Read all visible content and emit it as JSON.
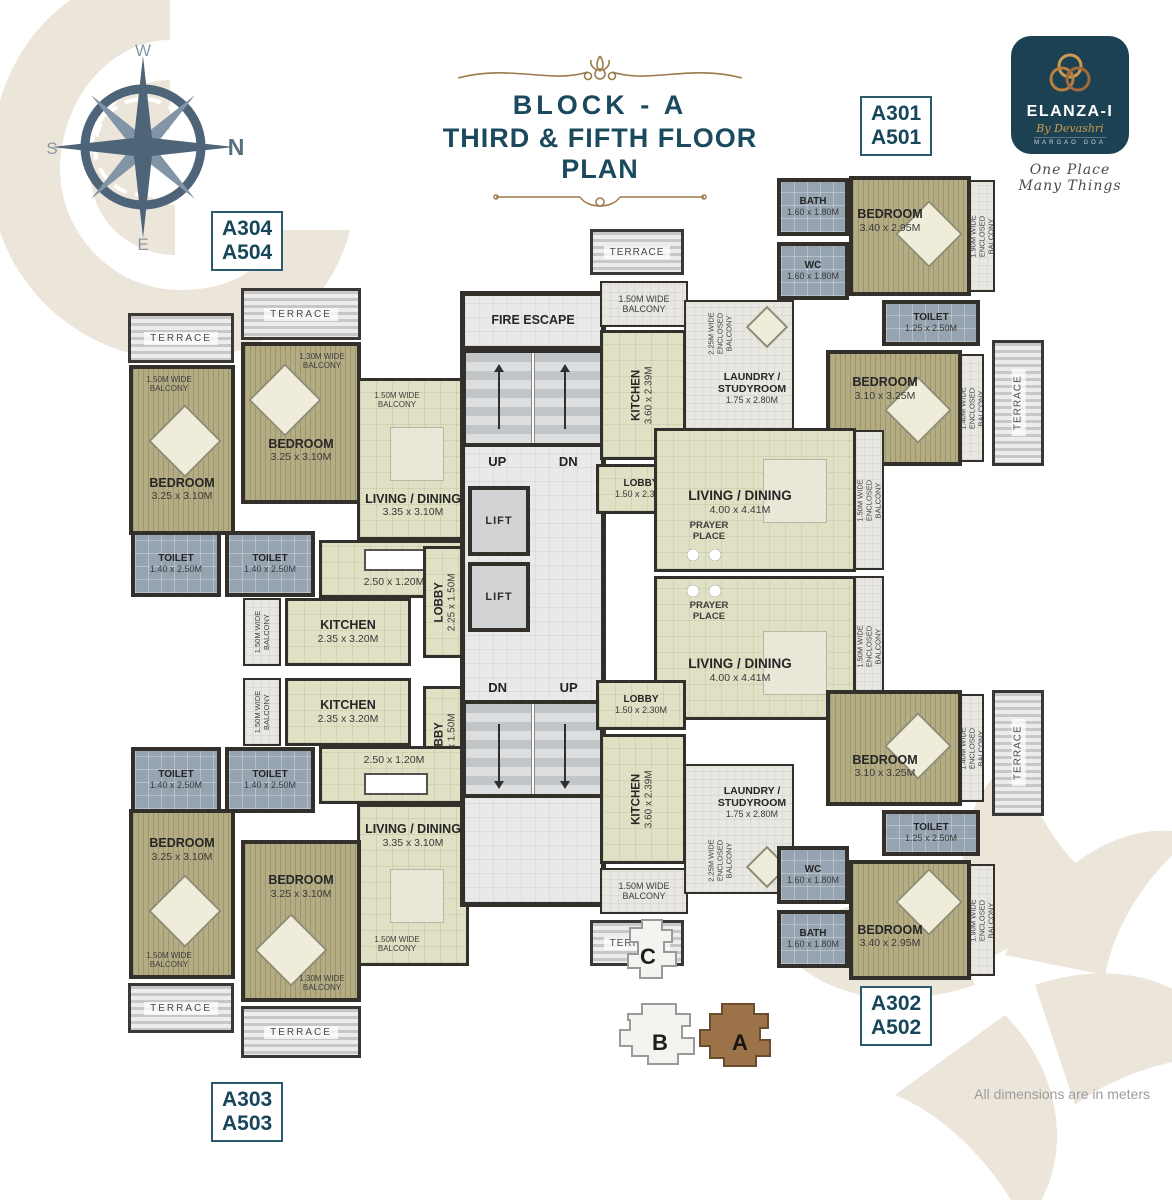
{
  "header": {
    "block": "BLOCK - A",
    "plan": "THIRD & FIFTH FLOOR PLAN"
  },
  "compass": {
    "n": "N",
    "w": "W",
    "s": "S",
    "e": "E"
  },
  "logo": {
    "brand": "ELANZA-I",
    "by": "By Devashri",
    "location": "MARGAO GOA",
    "tagline": "One Place Many Things"
  },
  "units": {
    "top_left": [
      "A304",
      "A504"
    ],
    "top_right": [
      "A301",
      "A501"
    ],
    "bottom_right": [
      "A302",
      "A502"
    ],
    "bottom_left": [
      "A303",
      "A503"
    ]
  },
  "core": {
    "fire_escape": "FIRE ESCAPE",
    "lift": "LIFT",
    "up": "UP",
    "dn": "DN"
  },
  "labels": {
    "terrace": "TERRACE",
    "prayer": "PRAYER PLACE",
    "dining_dim": "2.50 x 1.20M",
    "balcony_150": "1.50M WIDE BALCONY",
    "balcony_130": "1.30M WIDE BALCONY",
    "encl_150": "1.50M WIDE ENCLOSED BALCONY",
    "encl_225": "2.25M WIDE ENCLOSED BALCONY",
    "encl_190": "1.90M WIDE ENCLOSED BALCONY",
    "encl_140": "1.40M WIDE ENCLOSED BALCONY"
  },
  "rooms": {
    "bedroom_325": {
      "name": "BEDROOM",
      "dim": "3.25 x 3.10M"
    },
    "bedroom_340": {
      "name": "BEDROOM",
      "dim": "3.40 x 2.95M"
    },
    "bedroom_310": {
      "name": "BEDROOM",
      "dim": "3.10 x 3.25M"
    },
    "toilet_140": {
      "name": "TOILET",
      "dim": "1.40 x 2.50M"
    },
    "toilet_125": {
      "name": "TOILET",
      "dim": "1.25 x 2.50M"
    },
    "bath": {
      "name": "BATH",
      "dim": "1.60 x 1.80M"
    },
    "wc": {
      "name": "WC",
      "dim": "1.60 x 1.80M"
    },
    "living_335": {
      "name": "LIVING / DINING",
      "dim": "3.35 x 3.10M"
    },
    "living_400": {
      "name": "LIVING / DINING",
      "dim": "4.00 x 4.41M"
    },
    "kitchen_235": {
      "name": "KITCHEN",
      "dim": "2.35 x 3.20M"
    },
    "kitchen_360": {
      "name": "KITCHEN",
      "dim": "3.60 x 2.39M"
    },
    "laundry": {
      "name": "LAUNDRY / STUDYROOM",
      "dim": "1.75 x 2.80M"
    },
    "lobby_225": {
      "name": "LOBBY",
      "dim": "2.25 x 1.50M"
    },
    "lobby_150": {
      "name": "LOBBY",
      "dim": "1.50 x 2.30M"
    }
  },
  "site_key": {
    "a": "A",
    "b": "B",
    "c": "C"
  },
  "footnote": "All dimensions are in meters"
}
